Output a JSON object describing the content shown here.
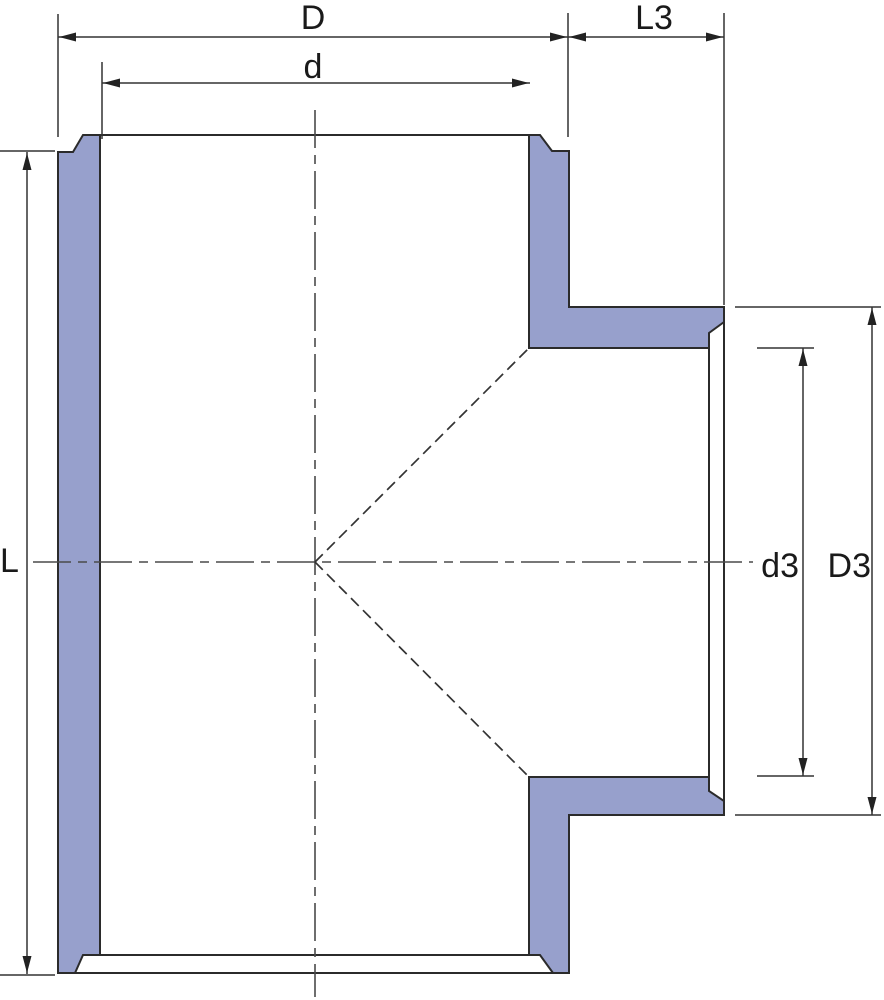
{
  "diagram": {
    "type": "technical_drawing_cross_section",
    "canvas": {
      "width": 884,
      "height": 1000,
      "background": "#ffffff"
    },
    "colors": {
      "wall_fill": "#97A0CC",
      "outline": "#2b2b2b",
      "dimension": "#333333",
      "centerline": "#4a4a4a",
      "text": "#1a1a1a"
    },
    "solids": [
      {
        "name": "left-wall-section",
        "points": [
          [
            58,
            152
          ],
          [
            73,
            152
          ],
          [
            83,
            135
          ],
          [
            100,
            135
          ],
          [
            100,
            955
          ],
          [
            83,
            955
          ],
          [
            75,
            973
          ],
          [
            58,
            973
          ]
        ]
      },
      {
        "name": "upper-right-wall-and-branch-top-section",
        "points": [
          [
            529,
            135
          ],
          [
            540,
            135
          ],
          [
            552,
            151
          ],
          [
            569,
            151
          ],
          [
            569,
            307
          ],
          [
            724,
            307
          ],
          [
            724,
            322
          ],
          [
            709,
            333
          ],
          [
            709,
            348
          ],
          [
            529,
            348
          ]
        ]
      },
      {
        "name": "lower-right-wall-and-branch-bottom-section",
        "points": [
          [
            529,
            777
          ],
          [
            709,
            777
          ],
          [
            709,
            791
          ],
          [
            724,
            801
          ],
          [
            724,
            815
          ],
          [
            569,
            815
          ],
          [
            569,
            973
          ],
          [
            553,
            973
          ],
          [
            540,
            955
          ],
          [
            529,
            955
          ]
        ]
      }
    ],
    "outline_lines": [
      {
        "name": "top-mouth-rim-line",
        "x1": 83,
        "y1": 135,
        "x2": 540,
        "y2": 135
      },
      {
        "name": "bottom-mouth-inner-line",
        "x1": 83,
        "y1": 955,
        "x2": 540,
        "y2": 955
      },
      {
        "name": "bottom-mouth-face-line",
        "x1": 58,
        "y1": 973,
        "x2": 569,
        "y2": 973
      },
      {
        "name": "branch-mouth-inner-line",
        "x1": 709,
        "y1": 333,
        "x2": 709,
        "y2": 791
      },
      {
        "name": "branch-mouth-face-line",
        "x1": 724,
        "y1": 307,
        "x2": 724,
        "y2": 815
      }
    ],
    "centerlines": [
      {
        "name": "vertical-centerline",
        "x1": 315,
        "y1": 110,
        "x2": 315,
        "y2": 997
      },
      {
        "name": "horizontal-centerline",
        "x1": 33,
        "y1": 562,
        "x2": 753,
        "y2": 562
      }
    ],
    "hidden_lines": [
      {
        "name": "socket-transition-upper-dashed",
        "x1": 315,
        "y1": 562,
        "x2": 529,
        "y2": 348
      },
      {
        "name": "socket-transition-lower-dashed",
        "x1": 315,
        "y1": 562,
        "x2": 529,
        "y2": 777
      }
    ],
    "dimension_lines": [
      {
        "name": "dim-line-D",
        "x1": 58,
        "y1": 37,
        "x2": 568,
        "y2": 37
      },
      {
        "name": "dim-line-L3",
        "x1": 568,
        "y1": 37,
        "x2": 724,
        "y2": 37
      },
      {
        "name": "dim-line-d",
        "x1": 102,
        "y1": 83,
        "x2": 530,
        "y2": 83
      },
      {
        "name": "dim-line-L",
        "x1": 27,
        "y1": 152,
        "x2": 27,
        "y2": 974
      },
      {
        "name": "dim-line-d3",
        "x1": 803,
        "y1": 348,
        "x2": 803,
        "y2": 776
      },
      {
        "name": "dim-line-D3",
        "x1": 872,
        "y1": 307,
        "x2": 872,
        "y2": 815
      }
    ],
    "extension_lines": [
      {
        "name": "ext-line-D-left",
        "x1": 58,
        "y1": 14,
        "x2": 58,
        "y2": 137
      },
      {
        "name": "ext-line-d-left",
        "x1": 102,
        "y1": 62,
        "x2": 102,
        "y2": 139
      },
      {
        "name": "ext-line-D-right",
        "x1": 568,
        "y1": 13,
        "x2": 568,
        "y2": 137
      },
      {
        "name": "ext-line-L3-right",
        "x1": 724,
        "y1": 13,
        "x2": 724,
        "y2": 305
      },
      {
        "name": "ext-tick-L-top",
        "x1": 0,
        "y1": 151,
        "x2": 55,
        "y2": 151
      },
      {
        "name": "ext-tick-L-bottom",
        "x1": 0,
        "y1": 975,
        "x2": 55,
        "y2": 975
      },
      {
        "name": "ext-tick-d3-top",
        "x1": 757,
        "y1": 348,
        "x2": 814,
        "y2": 348
      },
      {
        "name": "ext-tick-d3-bottom",
        "x1": 757,
        "y1": 776,
        "x2": 814,
        "y2": 776
      },
      {
        "name": "ext-line-D3-top",
        "x1": 735,
        "y1": 307,
        "x2": 881,
        "y2": 307
      },
      {
        "name": "ext-line-D3-bottom",
        "x1": 735,
        "y1": 815,
        "x2": 881,
        "y2": 815
      }
    ],
    "arrowheads": [
      {
        "name": "arrow-D-left",
        "tip": [
          59,
          37
        ],
        "dir": "left"
      },
      {
        "name": "arrow-D-right",
        "tip": [
          567,
          37
        ],
        "dir": "right"
      },
      {
        "name": "arrow-L3-left",
        "tip": [
          569,
          37
        ],
        "dir": "left"
      },
      {
        "name": "arrow-L3-right",
        "tip": [
          723,
          37
        ],
        "dir": "right"
      },
      {
        "name": "arrow-d-left",
        "tip": [
          103,
          83
        ],
        "dir": "left"
      },
      {
        "name": "arrow-d-right",
        "tip": [
          529,
          83
        ],
        "dir": "right"
      },
      {
        "name": "arrow-L-top",
        "tip": [
          27,
          153
        ],
        "dir": "up"
      },
      {
        "name": "arrow-L-bottom",
        "tip": [
          27,
          973
        ],
        "dir": "down"
      },
      {
        "name": "arrow-d3-top",
        "tip": [
          803,
          349
        ],
        "dir": "up"
      },
      {
        "name": "arrow-d3-bottom",
        "tip": [
          803,
          775
        ],
        "dir": "down"
      },
      {
        "name": "arrow-D3-top",
        "tip": [
          872,
          308
        ],
        "dir": "up"
      },
      {
        "name": "arrow-D3-bottom",
        "tip": [
          872,
          814
        ],
        "dir": "down"
      }
    ],
    "texts": [
      {
        "name": "dim-label-D",
        "text": "D",
        "x": 313,
        "y": 29,
        "anchor": "middle"
      },
      {
        "name": "dim-label-d",
        "text": "d",
        "x": 313,
        "y": 78,
        "anchor": "middle"
      },
      {
        "name": "dim-label-L3",
        "text": "L3",
        "x": 654,
        "y": 29,
        "anchor": "middle"
      },
      {
        "name": "dim-label-L",
        "text": "L",
        "x": 0,
        "y": 572,
        "anchor": "start"
      },
      {
        "name": "dim-label-d3",
        "text": "d3",
        "x": 799,
        "y": 577,
        "anchor": "end"
      },
      {
        "name": "dim-label-D3",
        "text": "D3",
        "x": 871,
        "y": 577,
        "anchor": "end"
      }
    ],
    "arrow_geometry": {
      "length": 17,
      "half_width": 4.5
    }
  }
}
